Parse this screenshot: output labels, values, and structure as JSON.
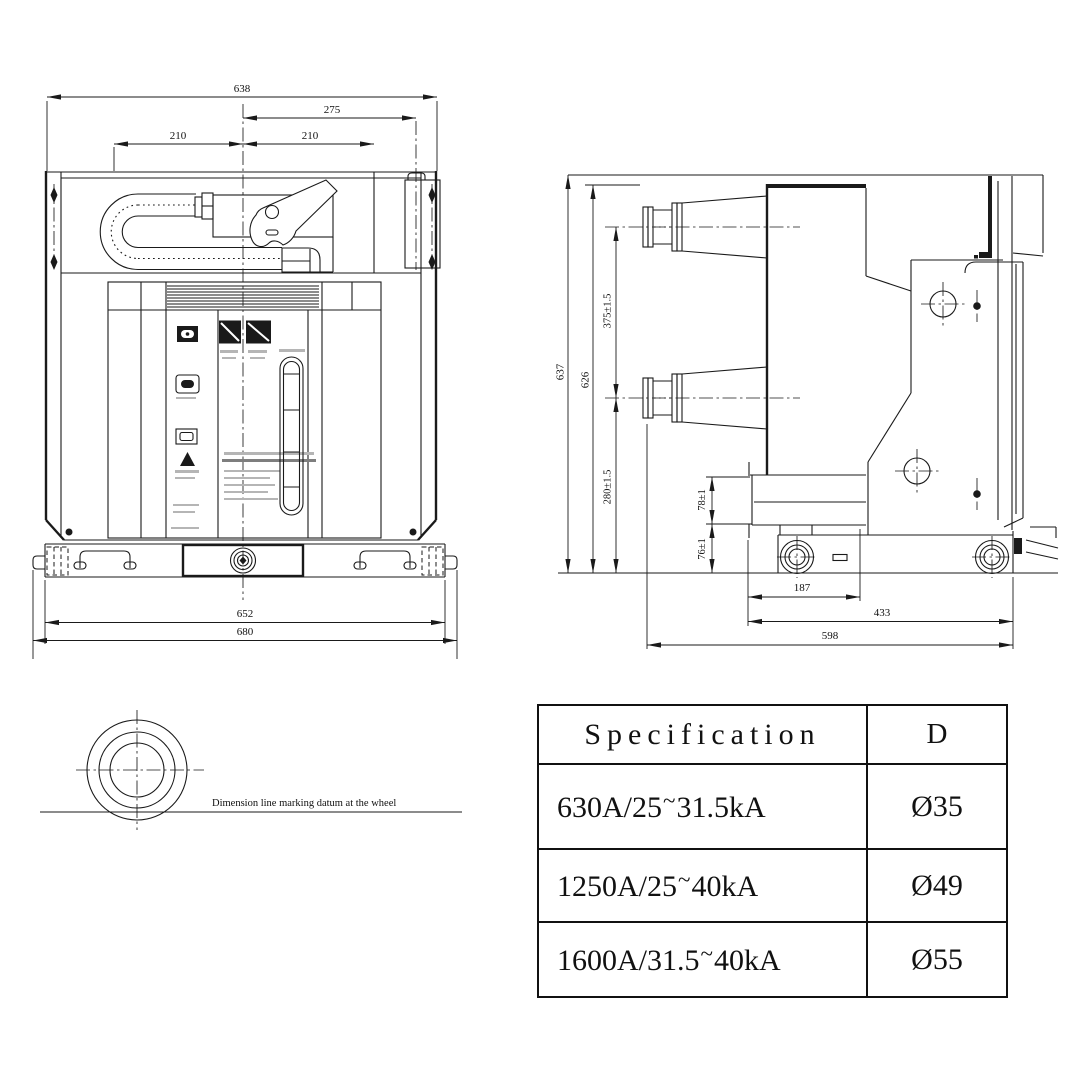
{
  "front_view": {
    "dim_638": "638",
    "dim_275": "275",
    "dim_210_left": "210",
    "dim_210_right": "210",
    "dim_652": "652",
    "dim_680": "680"
  },
  "side_view": {
    "dim_637": "637",
    "dim_626": "626",
    "dim_375": "375±1.5",
    "dim_280": "280±1.5",
    "dim_78": "78±1",
    "dim_76": "76±1",
    "dim_187": "187",
    "dim_433": "433",
    "dim_598": "598"
  },
  "wheel_detail": {
    "note": "Dimension line marking datum at the wheel"
  },
  "spec_table": {
    "header": {
      "spec": "Specification",
      "d": "D"
    },
    "tilde": "~",
    "rows": [
      {
        "spec_pre": "630A/25",
        "spec_post": "31.5kA",
        "d": "Ø35"
      },
      {
        "spec_pre": "1250A/25",
        "spec_post": "40kA",
        "d": "Ø49"
      },
      {
        "spec_pre": "1600A/31.5",
        "spec_post": "40kA",
        "d": "Ø55"
      }
    ]
  }
}
